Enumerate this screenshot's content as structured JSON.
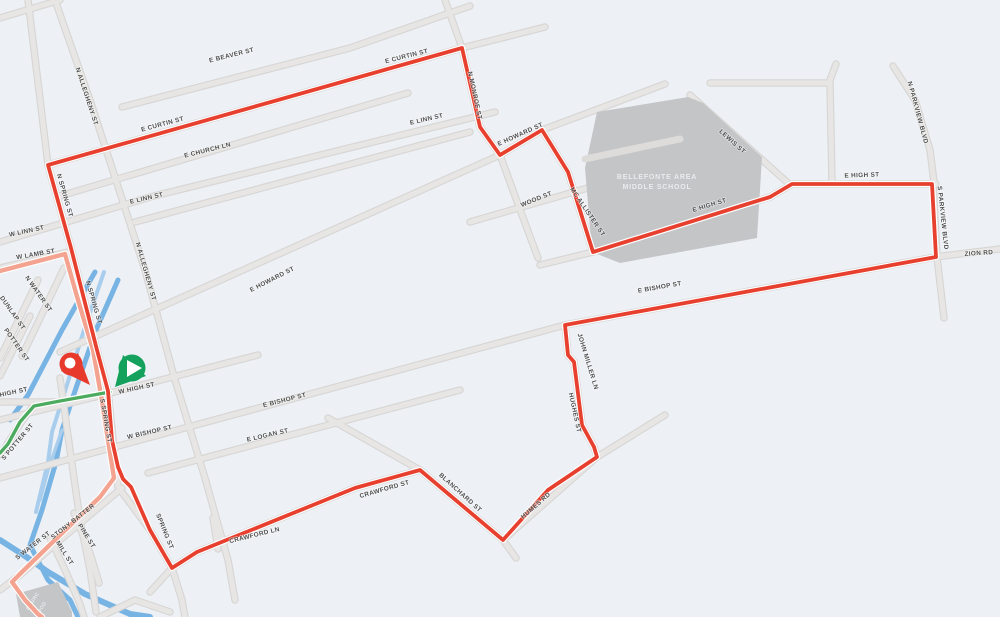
{
  "colors": {
    "background": "#edf1f6",
    "street": "#e7e6e4",
    "street_casing": "#d7d6d4",
    "route_red": "#e8402f",
    "route_faded": "#f3a38f",
    "route_green": "#4cab5f",
    "water": "#77b3e3",
    "water_light": "#a9cdec",
    "building": "#c4c5c7",
    "building_text": "#e9ebee",
    "label": "#4f4f4f",
    "marker_red": "#e73a2c",
    "marker_green": "#13a15b"
  },
  "markers": {
    "end": "red-pin-marker",
    "start": "green-play-marker"
  },
  "school": {
    "line1": "BELLEFONTE AREA",
    "line2": "MIDDLE SCHOOL"
  },
  "church": {
    "line1": "CHURC",
    "line2": "GOOD"
  },
  "street_labels": [
    {
      "t": "E BEAVER ST",
      "x": 232,
      "y": 57,
      "r": -14
    },
    {
      "t": "E CURTIN ST",
      "x": 163,
      "y": 126,
      "r": -15
    },
    {
      "t": "E CURTIN ST",
      "x": 407,
      "y": 58,
      "r": -14
    },
    {
      "t": "E CHURCH LN",
      "x": 208,
      "y": 152,
      "r": -14
    },
    {
      "t": "W LINN ST",
      "x": 27,
      "y": 233,
      "r": -12
    },
    {
      "t": "E LINN ST",
      "x": 147,
      "y": 200,
      "r": -13
    },
    {
      "t": "E LINN ST",
      "x": 427,
      "y": 121,
      "r": -13
    },
    {
      "t": "W LAMB ST",
      "x": 36,
      "y": 256,
      "r": -10
    },
    {
      "t": "N SPRING ST",
      "x": 63,
      "y": 196,
      "r": 74
    },
    {
      "t": "N SPRING ST",
      "x": 92,
      "y": 303,
      "r": 74
    },
    {
      "t": "N ALLEGHENY ST",
      "x": 85,
      "y": 97,
      "r": 72
    },
    {
      "t": "N ALLEGHENY ST",
      "x": 144,
      "y": 272,
      "r": 74
    },
    {
      "t": "N MONROE ST",
      "x": 473,
      "y": 96,
      "r": 78
    },
    {
      "t": "E HOWARD ST",
      "x": 273,
      "y": 281,
      "r": -27
    },
    {
      "t": "E HOWARD ST",
      "x": 521,
      "y": 136,
      "r": -24
    },
    {
      "t": "WOOD ST",
      "x": 537,
      "y": 201,
      "r": -22
    },
    {
      "t": "MC ALLISTER ST",
      "x": 586,
      "y": 213,
      "r": 56
    },
    {
      "t": "LEWIS ST",
      "x": 731,
      "y": 143,
      "r": 42
    },
    {
      "t": "E HIGH ST",
      "x": 710,
      "y": 207,
      "r": -17
    },
    {
      "t": "E HIGH ST",
      "x": 862,
      "y": 177,
      "r": -2
    },
    {
      "t": "N PARKVIEW BLVD",
      "x": 916,
      "y": 113,
      "r": 75
    },
    {
      "t": "S PARKVIEW BLVD",
      "x": 941,
      "y": 218,
      "r": 84
    },
    {
      "t": "ZION RD",
      "x": 979,
      "y": 255,
      "r": -4
    },
    {
      "t": "E BISHOP ST",
      "x": 660,
      "y": 289,
      "r": -10
    },
    {
      "t": "E BISHOP ST",
      "x": 285,
      "y": 402,
      "r": -14
    },
    {
      "t": "E LOGAN ST",
      "x": 268,
      "y": 437,
      "r": -13
    },
    {
      "t": "W BISHOP ST",
      "x": 150,
      "y": 434,
      "r": -13
    },
    {
      "t": "W HIGH ST",
      "x": 137,
      "y": 390,
      "r": -12
    },
    {
      "t": "S SPRING ST",
      "x": 104,
      "y": 421,
      "r": 80
    },
    {
      "t": "JOHN MILLER LN",
      "x": 586,
      "y": 362,
      "r": 73
    },
    {
      "t": "HUGHES ST",
      "x": 573,
      "y": 413,
      "r": 78
    },
    {
      "t": "HUMES RD",
      "x": 537,
      "y": 507,
      "r": -41
    },
    {
      "t": "BLANCHARD ST",
      "x": 459,
      "y": 494,
      "r": 42
    },
    {
      "t": "CRAWFORD ST",
      "x": 385,
      "y": 491,
      "r": -16
    },
    {
      "t": "CRAWFORD LN",
      "x": 255,
      "y": 537,
      "r": -14
    },
    {
      "t": "SPRING ST",
      "x": 163,
      "y": 532,
      "r": 68
    },
    {
      "t": "N WATER ST",
      "x": 37,
      "y": 295,
      "r": 55
    },
    {
      "t": "DUNLAP ST",
      "x": 11,
      "y": 314,
      "r": 55
    },
    {
      "t": "POTTER ST",
      "x": 15,
      "y": 346,
      "r": 55
    },
    {
      "t": "HIGH ST",
      "x": 14,
      "y": 394,
      "r": -12
    },
    {
      "t": "S POTTER ST",
      "x": 19,
      "y": 443,
      "r": -50
    },
    {
      "t": "S WATER ST",
      "x": 34,
      "y": 547,
      "r": -38
    },
    {
      "t": "STONY BATTER",
      "x": 74,
      "y": 523,
      "r": -38
    },
    {
      "t": "MILL ST",
      "x": 63,
      "y": 554,
      "r": 58
    },
    {
      "t": "PINE ST",
      "x": 85,
      "y": 537,
      "r": 58
    }
  ]
}
